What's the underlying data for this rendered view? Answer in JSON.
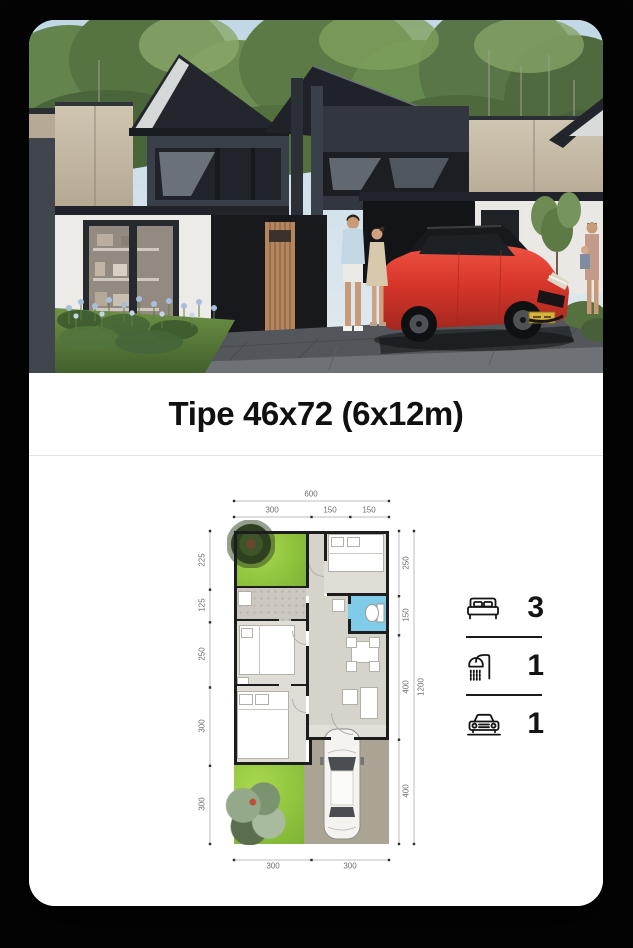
{
  "card": {
    "title": "Tipe 46x72 (6x12m)"
  },
  "stats": {
    "items": [
      {
        "icon": "bed-icon",
        "value": "3"
      },
      {
        "icon": "shower-icon",
        "value": "1"
      },
      {
        "icon": "car-icon",
        "value": "1"
      }
    ]
  },
  "floor_plan": {
    "dims": {
      "top_total": "600",
      "top_segments": [
        "300",
        "150",
        "150"
      ],
      "left_segments": [
        "225",
        "125",
        "250",
        "300",
        "300"
      ],
      "right_segments": [
        "250",
        "150",
        "400",
        "400"
      ],
      "right_total": "1200",
      "bottom_segments": [
        "300",
        "300"
      ]
    },
    "colors": {
      "grass": "#8fc43e",
      "bathroom": "#7fcbe8",
      "wall": "#1d1d1d",
      "room_floor": "#e0ddd6",
      "carport": "#a9a493",
      "accent_car": "#d8362b"
    }
  }
}
